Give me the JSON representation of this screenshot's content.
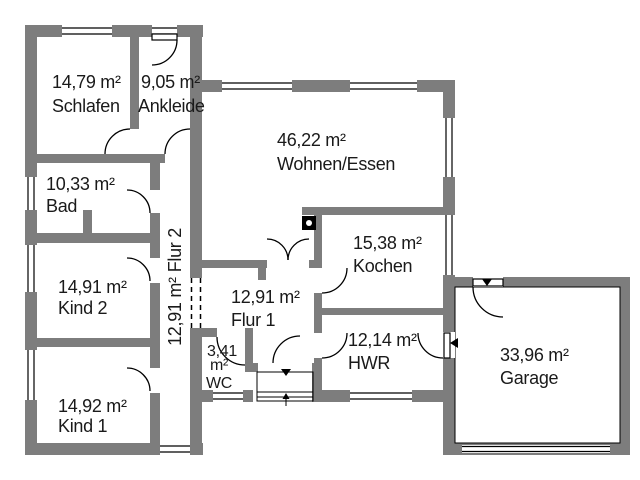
{
  "plan_type": "floor-plan",
  "colors": {
    "wall": "#7d7d7d",
    "line": "#000000",
    "text": "#1a1a1a",
    "background": "#ffffff"
  },
  "rooms": {
    "schlafen": {
      "area": "14,79 m²",
      "name": "Schlafen"
    },
    "ankleide": {
      "area": "9,05 m²",
      "name": "Ankleide"
    },
    "wohnen_essen": {
      "area": "46,22 m²",
      "name": "Wohnen/Essen"
    },
    "bad": {
      "area": "10,33 m²",
      "name": "Bad"
    },
    "kochen": {
      "area": "15,38 m²",
      "name": "Kochen"
    },
    "kind2": {
      "area": "14,91 m²",
      "name": "Kind 2"
    },
    "flur2": {
      "area": "12,91 m²",
      "name": "Flur 2"
    },
    "flur1": {
      "area": "12,91 m²",
      "name": "Flur 1"
    },
    "wc": {
      "area_line1": "3,41",
      "area_line2": "m²",
      "name": "WC"
    },
    "hwr": {
      "area": "12,14 m²",
      "name": "HWR"
    },
    "kind1": {
      "area": "14,92 m²",
      "name": "Kind 1"
    },
    "garage": {
      "area": "33,96 m²",
      "name": "Garage"
    }
  }
}
